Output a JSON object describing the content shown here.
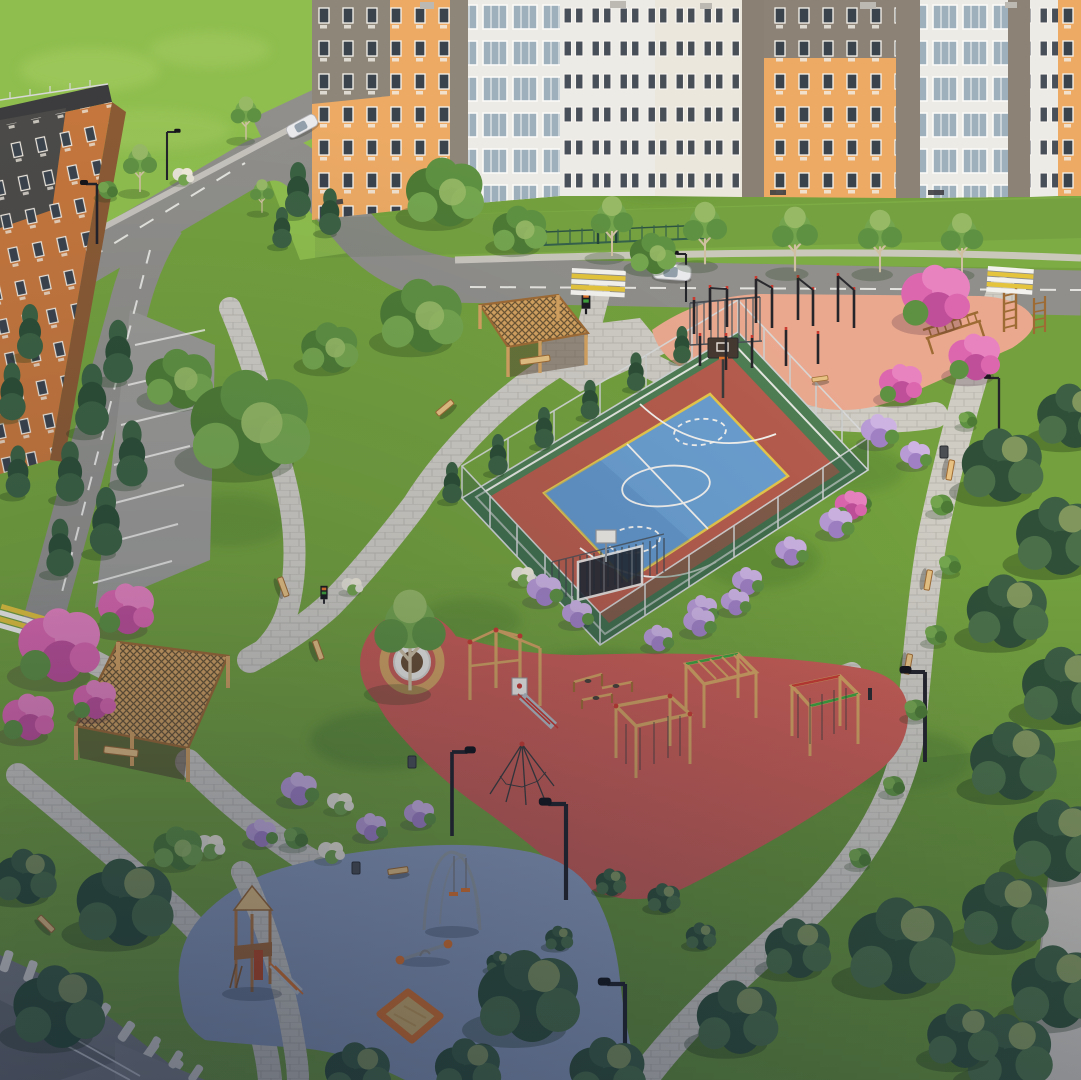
{
  "scene": {
    "type": "aerial-3d-architectural-render",
    "setting": "residential-courtyard-park",
    "objects": [
      "apartment-buildings",
      "access-roads",
      "parking-lot",
      "crosswalks",
      "white-cars",
      "fenced-basketball-court",
      "street-workout-area",
      "wooden-climbing-playground",
      "toddler-playground",
      "wooden-pergola-tunnels",
      "tree-in-round-planter",
      "paver-walkways",
      "benches",
      "street-lamps",
      "trash-bins",
      "info-signs",
      "deciduous-trees",
      "conifer-trees",
      "pink-flowering-trees",
      "lilac-shrubs",
      "flower-beds"
    ]
  },
  "palette": {
    "grassBase": "#74a13e",
    "grassBright": "#8fbe4e",
    "grassStrip": "#7dab44",
    "grassDark": "#54822f",
    "grassGlow": "#a5cc62",
    "road": "#908f8b",
    "parking": "#9b9a96",
    "lineWhite": "#f3f2ee",
    "lineYellow": "#e4c43c",
    "path": "#cfccc4",
    "pathEdge": "#b9b6ae",
    "courtGreen": "#4f7d53",
    "courtRed": "#b65c4c",
    "courtBlue": "#6b9fd0",
    "courtBlueDark": "#4d7fb4",
    "courtYellow": "#e7c84b",
    "fenceLight": "#ced2d2",
    "fenceGreen": "#2f5a43",
    "workoutPink": "#eaa98f",
    "redSurface": "#c95d54",
    "blueSurface": "#8c9cbb",
    "wood": "#d4a260",
    "woodDark": "#9e6b34",
    "woodLight": "#e6c182",
    "lattice": "#6d5633",
    "accentRed": "#c93a30",
    "accentGreen": "#3fa13c",
    "accentOrange": "#e0752c",
    "bldgOrange": "#ecaa64",
    "bldgGray": "#8e8679",
    "bldgDark": "#4b4a48",
    "bldgWhite": "#edebe6",
    "bldgCream": "#ece7dd",
    "brick": "#c4763c",
    "brickSide": "#8a5a34",
    "window": "#3a424c",
    "windowPane": "#9fb0bd",
    "roofWhite": "#f2f1ee",
    "treeG1": "#4d7b35",
    "treeG2": "#5f9142",
    "treeG3": "#74a54e",
    "treeLight": "#97b966",
    "treeD1": "#2f4f38",
    "treeD2": "#3d5f43",
    "treeD3": "#4b7049",
    "treeHi": "#b9c272",
    "conifer1": "#3b6142",
    "conifer2": "#2d4e36",
    "pink1": "#dd67af",
    "pink2": "#e883c0",
    "pink3": "#bf4f99",
    "lilac1": "#b89bd5",
    "lilac2": "#cdb3e2",
    "lilac3": "#a080c3",
    "flowerWhite": "#e7e3d7",
    "sand": "#d9b46c",
    "metal": "#929aa1",
    "carWhite": "#eaeaec",
    "wall": "#c9c5bd"
  }
}
